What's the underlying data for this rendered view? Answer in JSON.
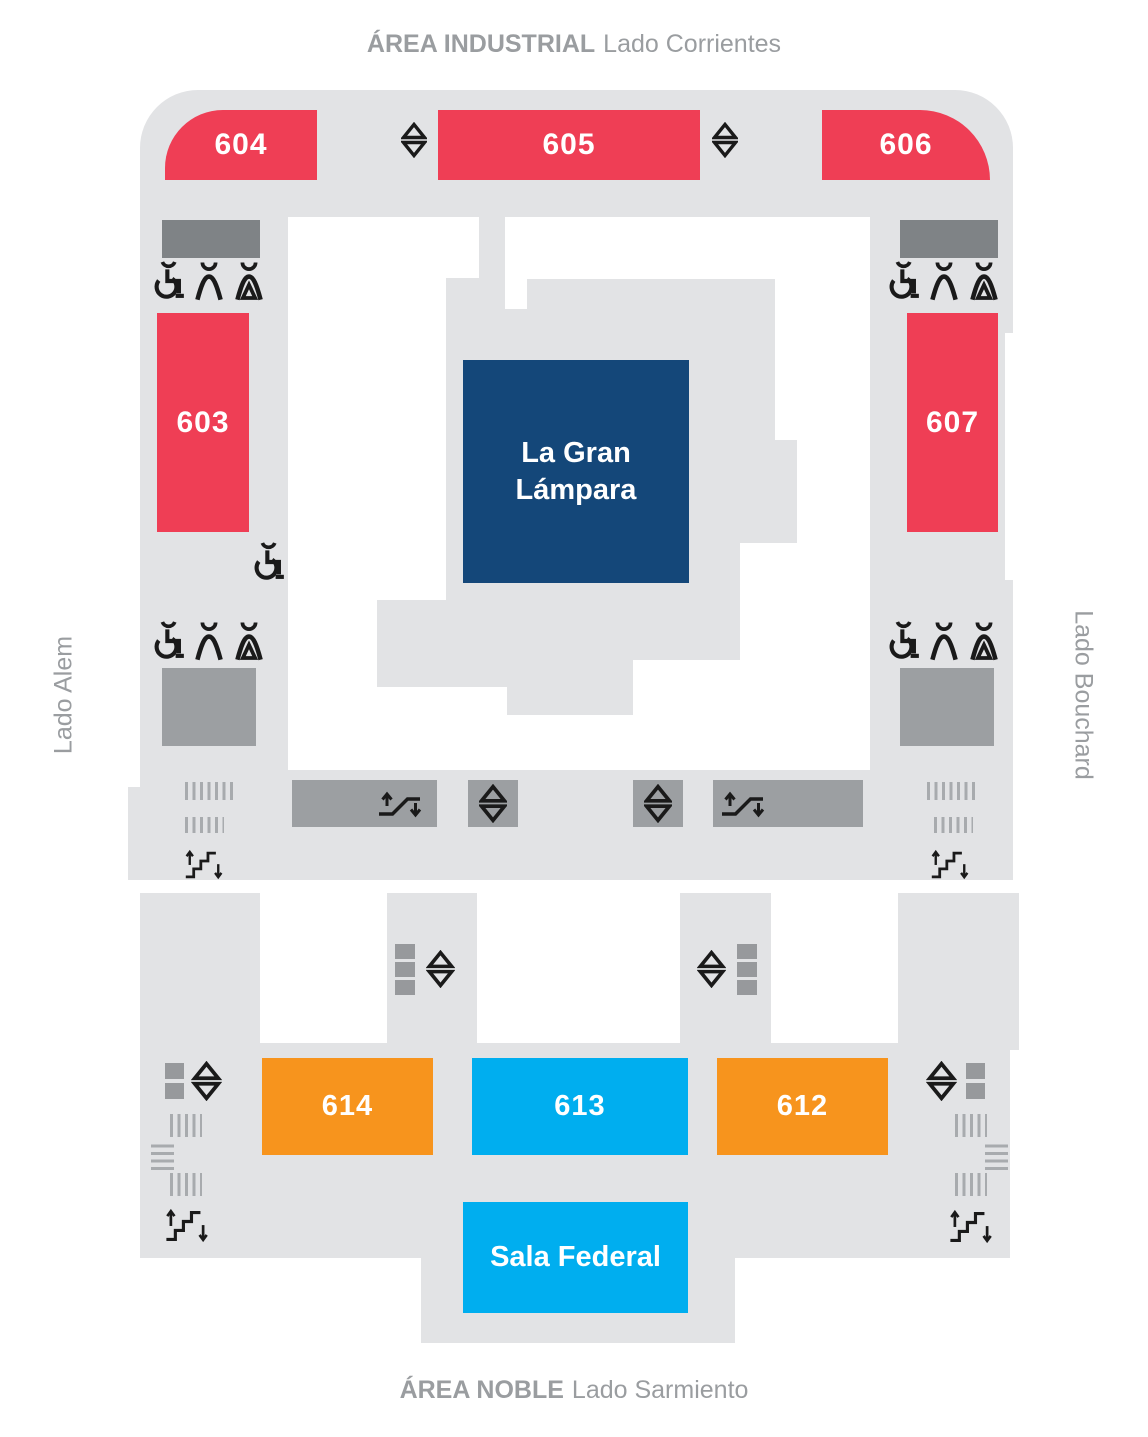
{
  "labels": {
    "top_bold": "ÁREA INDUSTRIAL",
    "top_rest": "Lado Corrientes",
    "bottom_bold": "ÁREA NOBLE",
    "bottom_rest": "Lado Sarmiento",
    "left": "Lado Alem",
    "right": "Lado Bouchard"
  },
  "rooms": {
    "r604": {
      "label": "604",
      "color": "#ef3e55"
    },
    "r605": {
      "label": "605",
      "color": "#ef3e55"
    },
    "r606": {
      "label": "606",
      "color": "#ef3e55"
    },
    "r603": {
      "label": "603",
      "color": "#ef3e55"
    },
    "r607": {
      "label": "607",
      "color": "#ef3e55"
    },
    "lampara": {
      "label_line1": "La Gran",
      "label_line2": "Lámpara",
      "color": "#144779"
    },
    "r614": {
      "label": "614",
      "color": "#f7941d"
    },
    "r613": {
      "label": "613",
      "color": "#00aeef"
    },
    "r612": {
      "label": "612",
      "color": "#f7941d"
    },
    "sala_federal": {
      "label": "Sala Federal",
      "color": "#00aeef"
    }
  },
  "icon_legend": [
    "elevator",
    "escalator",
    "stairs",
    "accessible-restroom",
    "mens-restroom",
    "womens-restroom"
  ],
  "colors": {
    "building": "#e2e3e5",
    "service_room_dark": "#7f8386",
    "service_room_medium": "#9c9fa2",
    "marker_square": "#97999c",
    "red": "#ef3e55",
    "orange": "#f7941d",
    "cyan": "#00aeef",
    "navy": "#144779",
    "label_text": "#9a9da0",
    "icon": "#1a1a1a"
  }
}
